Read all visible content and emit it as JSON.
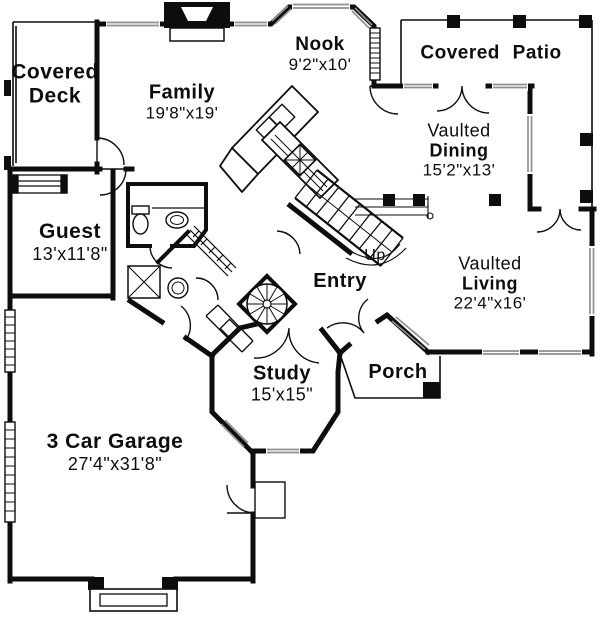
{
  "plan_title": "First floor plan",
  "colors": {
    "wall": "#0d0d0d",
    "window": "#8f8f8f",
    "background": "#ffffff"
  },
  "rooms": {
    "covered_deck": {
      "name_line1": "Covered",
      "name_line2": "Deck"
    },
    "family": {
      "name": "Family",
      "dims": "19'8\"x19'"
    },
    "nook": {
      "name": "Nook",
      "dims": "9'2\"x10'"
    },
    "covered_patio": {
      "name": "Covered  Patio"
    },
    "dining": {
      "qualifier": "Vaulted",
      "name": "Dining",
      "dims": "15'2\"x13'"
    },
    "living": {
      "qualifier": "Vaulted",
      "name": "Living",
      "dims": "22'4\"x16'"
    },
    "guest": {
      "name": "Guest",
      "dims": "13'x11'8\""
    },
    "entry": {
      "name": "Entry"
    },
    "stair": {
      "direction_label": "Up"
    },
    "study": {
      "name": "Study",
      "dims": "15'x15\""
    },
    "porch": {
      "name": "Porch"
    },
    "garage": {
      "name": "3 Car Garage",
      "dims": "27'4\"x31'8\""
    }
  }
}
